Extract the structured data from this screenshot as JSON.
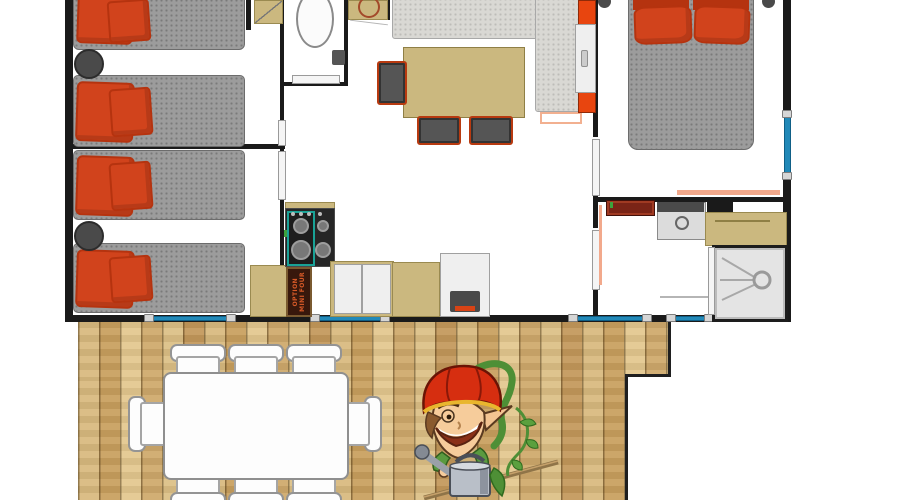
{
  "meta": {
    "type": "floor-plan",
    "description": "Top-down floor plan of a 3-bedroom mobile home chalet with kitchen, living-dining area, bathroom, WC and a large wooden terrace with outdoor dining table and gardener-elf mascot"
  },
  "labels": {
    "oven_line1": "OPTION",
    "oven_line2": "MINI FOUR"
  },
  "colors": {
    "wall": "#1a1a1a",
    "mattress": "#9c9c9c",
    "pillow": "#d1431c",
    "pillow_dark": "#b5330f",
    "tan": "#cbb87f",
    "tan_dark": "#9a8a50",
    "bench": "#d9d8d4",
    "window": "#2289b8",
    "window_dark": "#0f5f86",
    "chair_frame": "#b83a10",
    "seat": "#555555",
    "stove_teal": "#19a296",
    "oven_bg": "#38180c",
    "oven_text": "#d85a28",
    "radiator": "#7a2416",
    "salmon": "#f2a98c",
    "wood_a": "#d8b97e",
    "wood_b": "#c89f5e",
    "wood_c": "#e3c78e",
    "deck_edge": "#1f1f1f",
    "door": "#f5f5f5",
    "door_frame": "#9a9a9a",
    "shower": "#e4e4e4",
    "cabinet_orange": "#e8450f",
    "mascot_red": "#d62e10",
    "mascot_green": "#4e8f36",
    "mascot_skin": "#f6cc9b",
    "can_gray": "#b9bfc8"
  },
  "rooms": [
    {
      "id": "bedroom-1",
      "furniture": [
        "single-bed",
        "single-bed",
        "bedside-stool"
      ]
    },
    {
      "id": "bedroom-2",
      "furniture": [
        "single-bed",
        "single-bed",
        "bedside-stool"
      ]
    },
    {
      "id": "wc",
      "furniture": [
        "toilet",
        "cistern",
        "door"
      ]
    },
    {
      "id": "hallway",
      "furniture": [
        "wardrobe",
        "washbasin-unit",
        "doors"
      ]
    },
    {
      "id": "kitchen",
      "furniture": [
        "gas-hob",
        "mini-oven-option",
        "worktop",
        "cabinets",
        "fridge"
      ]
    },
    {
      "id": "living-dining",
      "furniture": [
        "corner-bench",
        "dining-table",
        "chair",
        "chair",
        "chair",
        "tall-cabinet"
      ]
    },
    {
      "id": "master-bedroom",
      "furniture": [
        "double-bed",
        "pillows",
        "door"
      ]
    },
    {
      "id": "bathroom",
      "furniture": [
        "towel-radiator",
        "washbasin",
        "counter",
        "shower",
        "door"
      ]
    },
    {
      "id": "terrace",
      "furniture": [
        "outdoor-table",
        "outdoor-chairs-x8",
        "mascot-illustration"
      ]
    }
  ],
  "windows": {
    "bottom_wall": 4,
    "right_wall": 1
  },
  "mascot": {
    "description": "cartoon gardener elf with red cap, watering can, vine and rake"
  }
}
